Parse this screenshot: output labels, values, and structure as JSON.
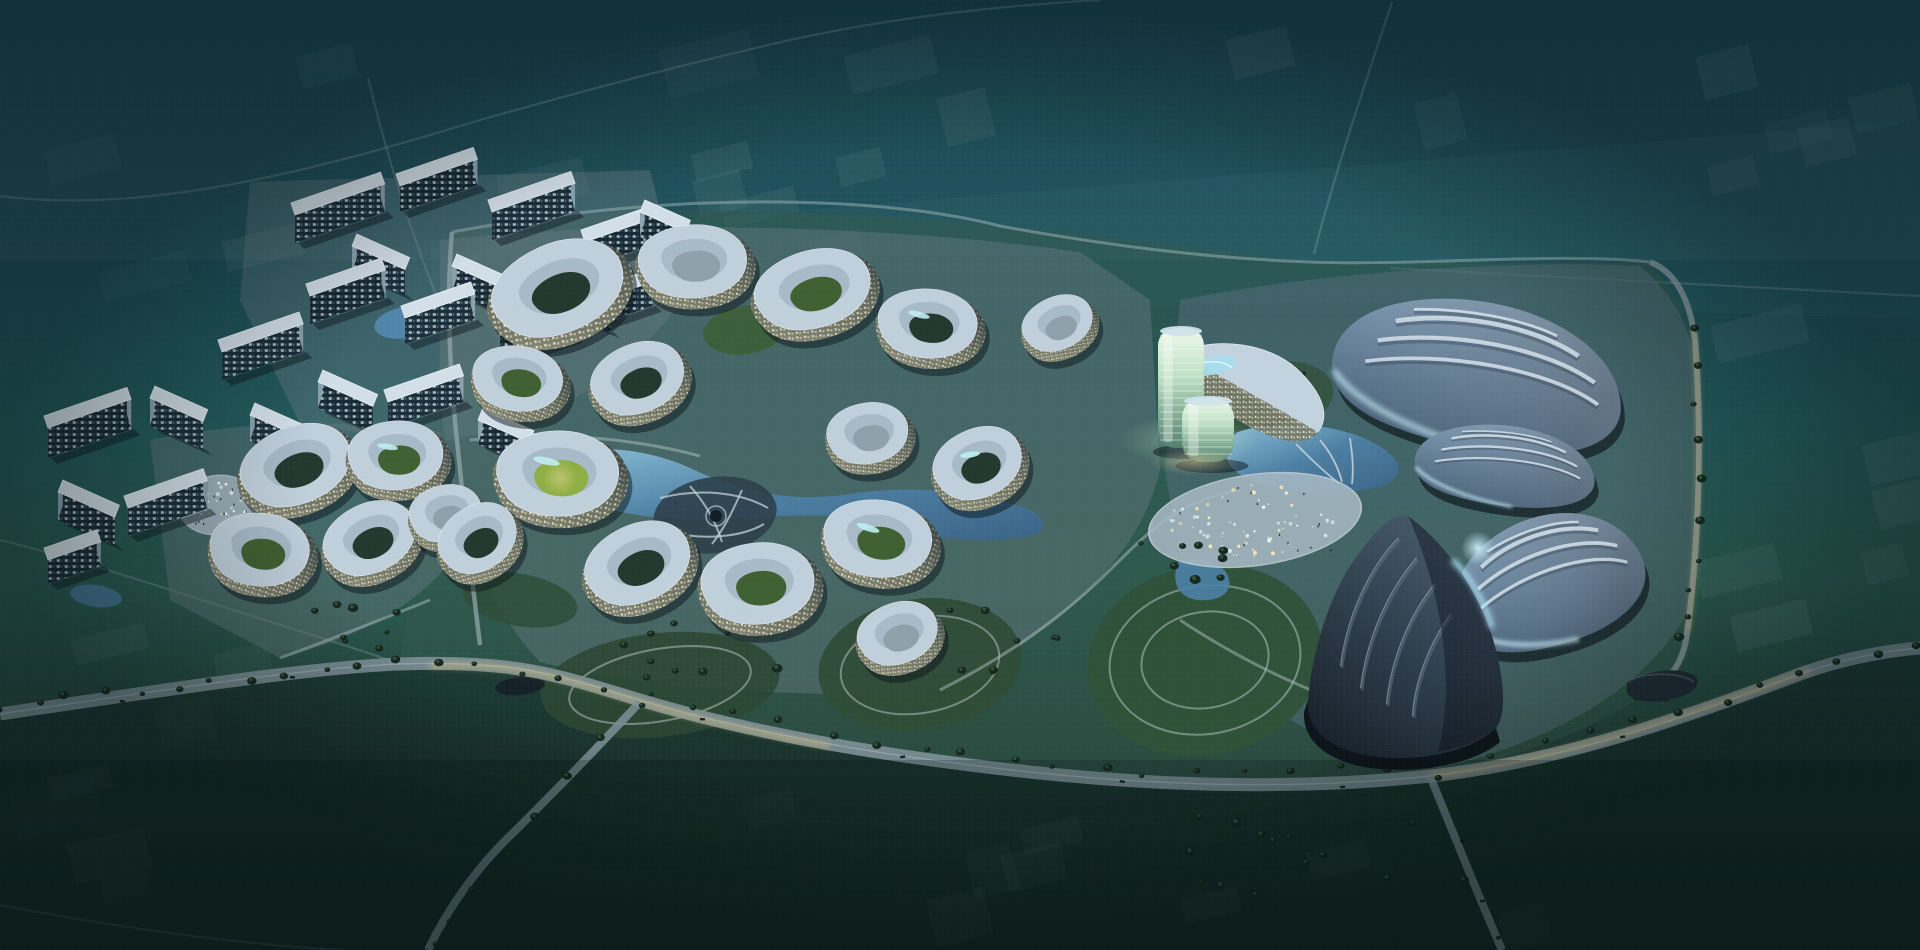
{
  "scene": {
    "type": "aerial-architectural-rendering",
    "setting": "futuristic masterplan campus at dusk, aerial view",
    "text_visible": false
  },
  "palette": {
    "sky_top": "#123c4a",
    "field_teal": "#20535a",
    "field_green": "#2a4f44",
    "field_dark": "#18302a",
    "site_tint": "#33584a",
    "platform": "#5f757c",
    "plaza": "#a9bac4",
    "roof_light": "#d3dfe8",
    "roof_edge": "#eef4f8",
    "facade_glow": "#e9e2bd",
    "petal_roof_a": "#c2d2de",
    "petal_roof_b": "#93a9b8",
    "water": "#4d80a6",
    "water_light": "#8fc3dd",
    "lawn": "#2f5138",
    "lawn_lit": "#7fa03e",
    "glass_hi": "#eef9ec",
    "glass_lo": "#55806f",
    "glow_warm": "#e8c87a",
    "shell_hi": "#aec4d8",
    "shell_mid": "#7d98b0",
    "shell_lo": "#4e6880",
    "shell_dark_hi": "#4d5f72",
    "shell_dark_lo": "#161f29",
    "rib_light": "#dce8f1",
    "cyan_glow": "#c9f0fb",
    "road": "#7d9097",
    "road_faint": "#8fa8ab",
    "tree": "#16281f",
    "tree_hi": "#3d5c41",
    "window_lit": "#cfe9ee",
    "window_warm": "#ffedb8",
    "speck": "#0c151b",
    "ghost": "#d7e8e4"
  },
  "districts": [
    {
      "id": "residential-north",
      "kind": "apartment-slab-cluster"
    },
    {
      "id": "residential-west",
      "kind": "apartment-slab-cluster"
    },
    {
      "id": "petal-cluster-west",
      "kind": "organic-petal-buildings"
    },
    {
      "id": "central-petal-campus",
      "kind": "organic-petal-buildings"
    },
    {
      "id": "glass-towers",
      "kind": "tower-pair"
    },
    {
      "id": "shell-halls-east",
      "kind": "shell-roofed-halls"
    },
    {
      "id": "event-plaza",
      "kind": "illuminated-plaza"
    },
    {
      "id": "great-lawns",
      "kind": "oval-lawns"
    },
    {
      "id": "boulevard",
      "kind": "tree-lined-road"
    }
  ],
  "counts": {
    "glass_towers": 2,
    "shell_halls": 4,
    "residential_slabs": 22,
    "petal_buildings": 20
  }
}
